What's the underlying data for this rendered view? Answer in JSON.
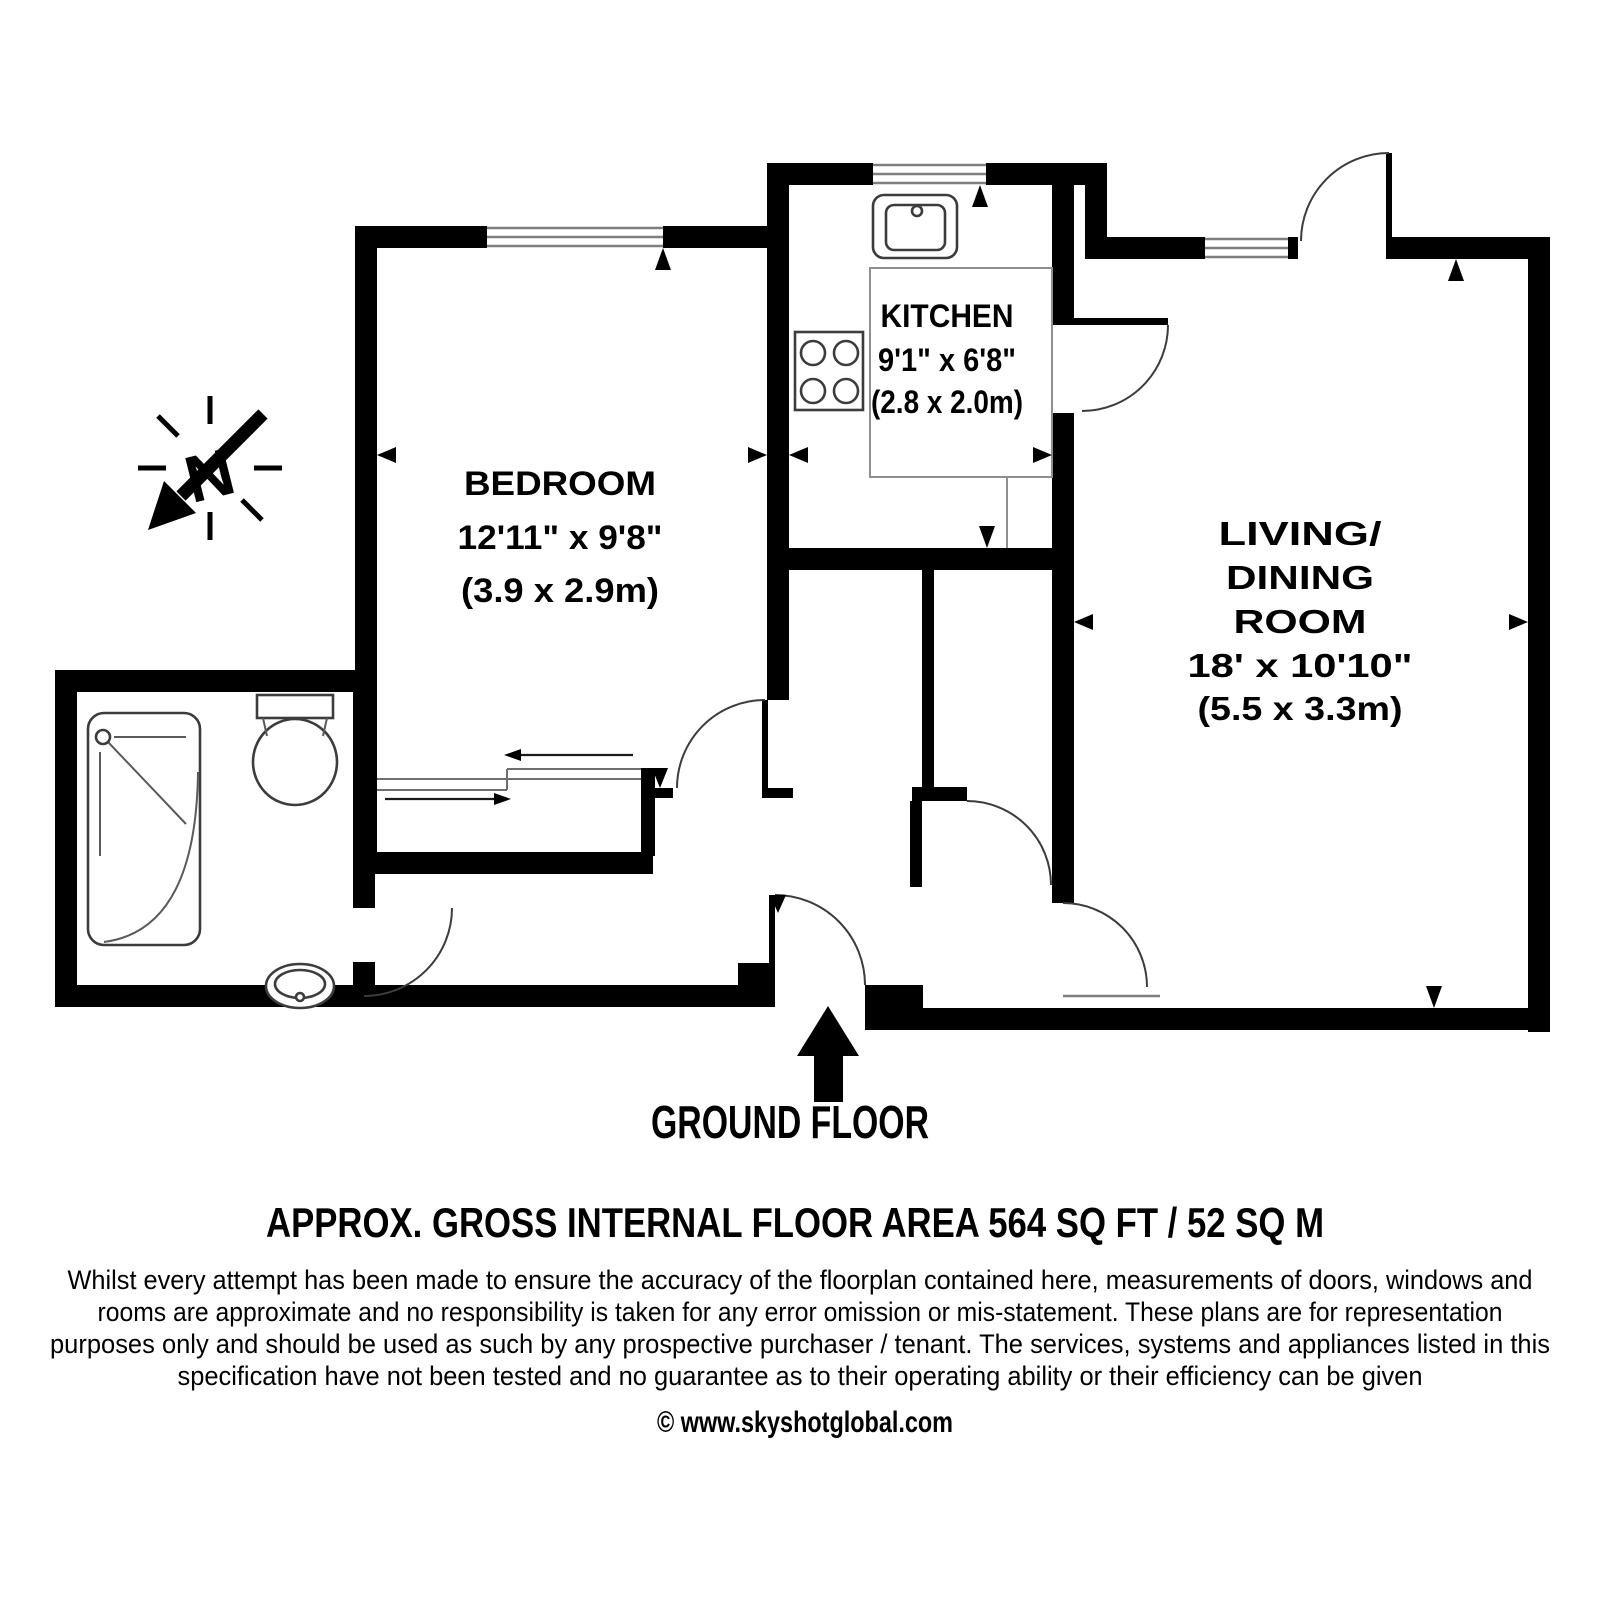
{
  "plan": {
    "floor_label": "GROUND FLOOR",
    "area_label": "APPROX. GROSS INTERNAL FLOOR AREA 564 SQ FT / 52 SQ M",
    "copyright": "© www.skyshotglobal.com",
    "disclaimer_lines": [
      "Whilst every attempt has been made to ensure the accuracy of the floorplan contained here, measurements of doors, windows and",
      "rooms are approximate and no responsibility is taken for any error omission or mis-statement. These plans are for representation",
      "purposes only and should be used as such by any prospective purchaser / tenant. The services, systems and appliances listed in this",
      "specification have not been tested and no guarantee as to their operating ability or their efficiency can be given"
    ],
    "compass": {
      "letter": "N"
    },
    "rooms": [
      {
        "id": "bedroom",
        "name": "BEDROOM",
        "dimensions_imperial": "12'11\" x 9'8\"",
        "dimensions_metric": "(3.9 x 2.9m)"
      },
      {
        "id": "kitchen",
        "name": "KITCHEN",
        "dimensions_imperial": "9'1\" x 6'8\"",
        "dimensions_metric": "(2.8 x 2.0m)"
      },
      {
        "id": "living_dining",
        "name_lines": [
          "LIVING/",
          "DINING",
          "ROOM"
        ],
        "dimensions_imperial": "18' x 10'10\"",
        "dimensions_metric": "(5.5 x 3.3m)"
      }
    ],
    "fixtures": [
      "shower",
      "toilet",
      "basin",
      "sink",
      "hob",
      "wardrobe",
      "entrance-arrow",
      "north-arrow"
    ],
    "colors": {
      "wall": "#000000",
      "background": "#ffffff",
      "fixture_line": "#3c3c3c",
      "window_line": "#7e7e7e"
    }
  }
}
